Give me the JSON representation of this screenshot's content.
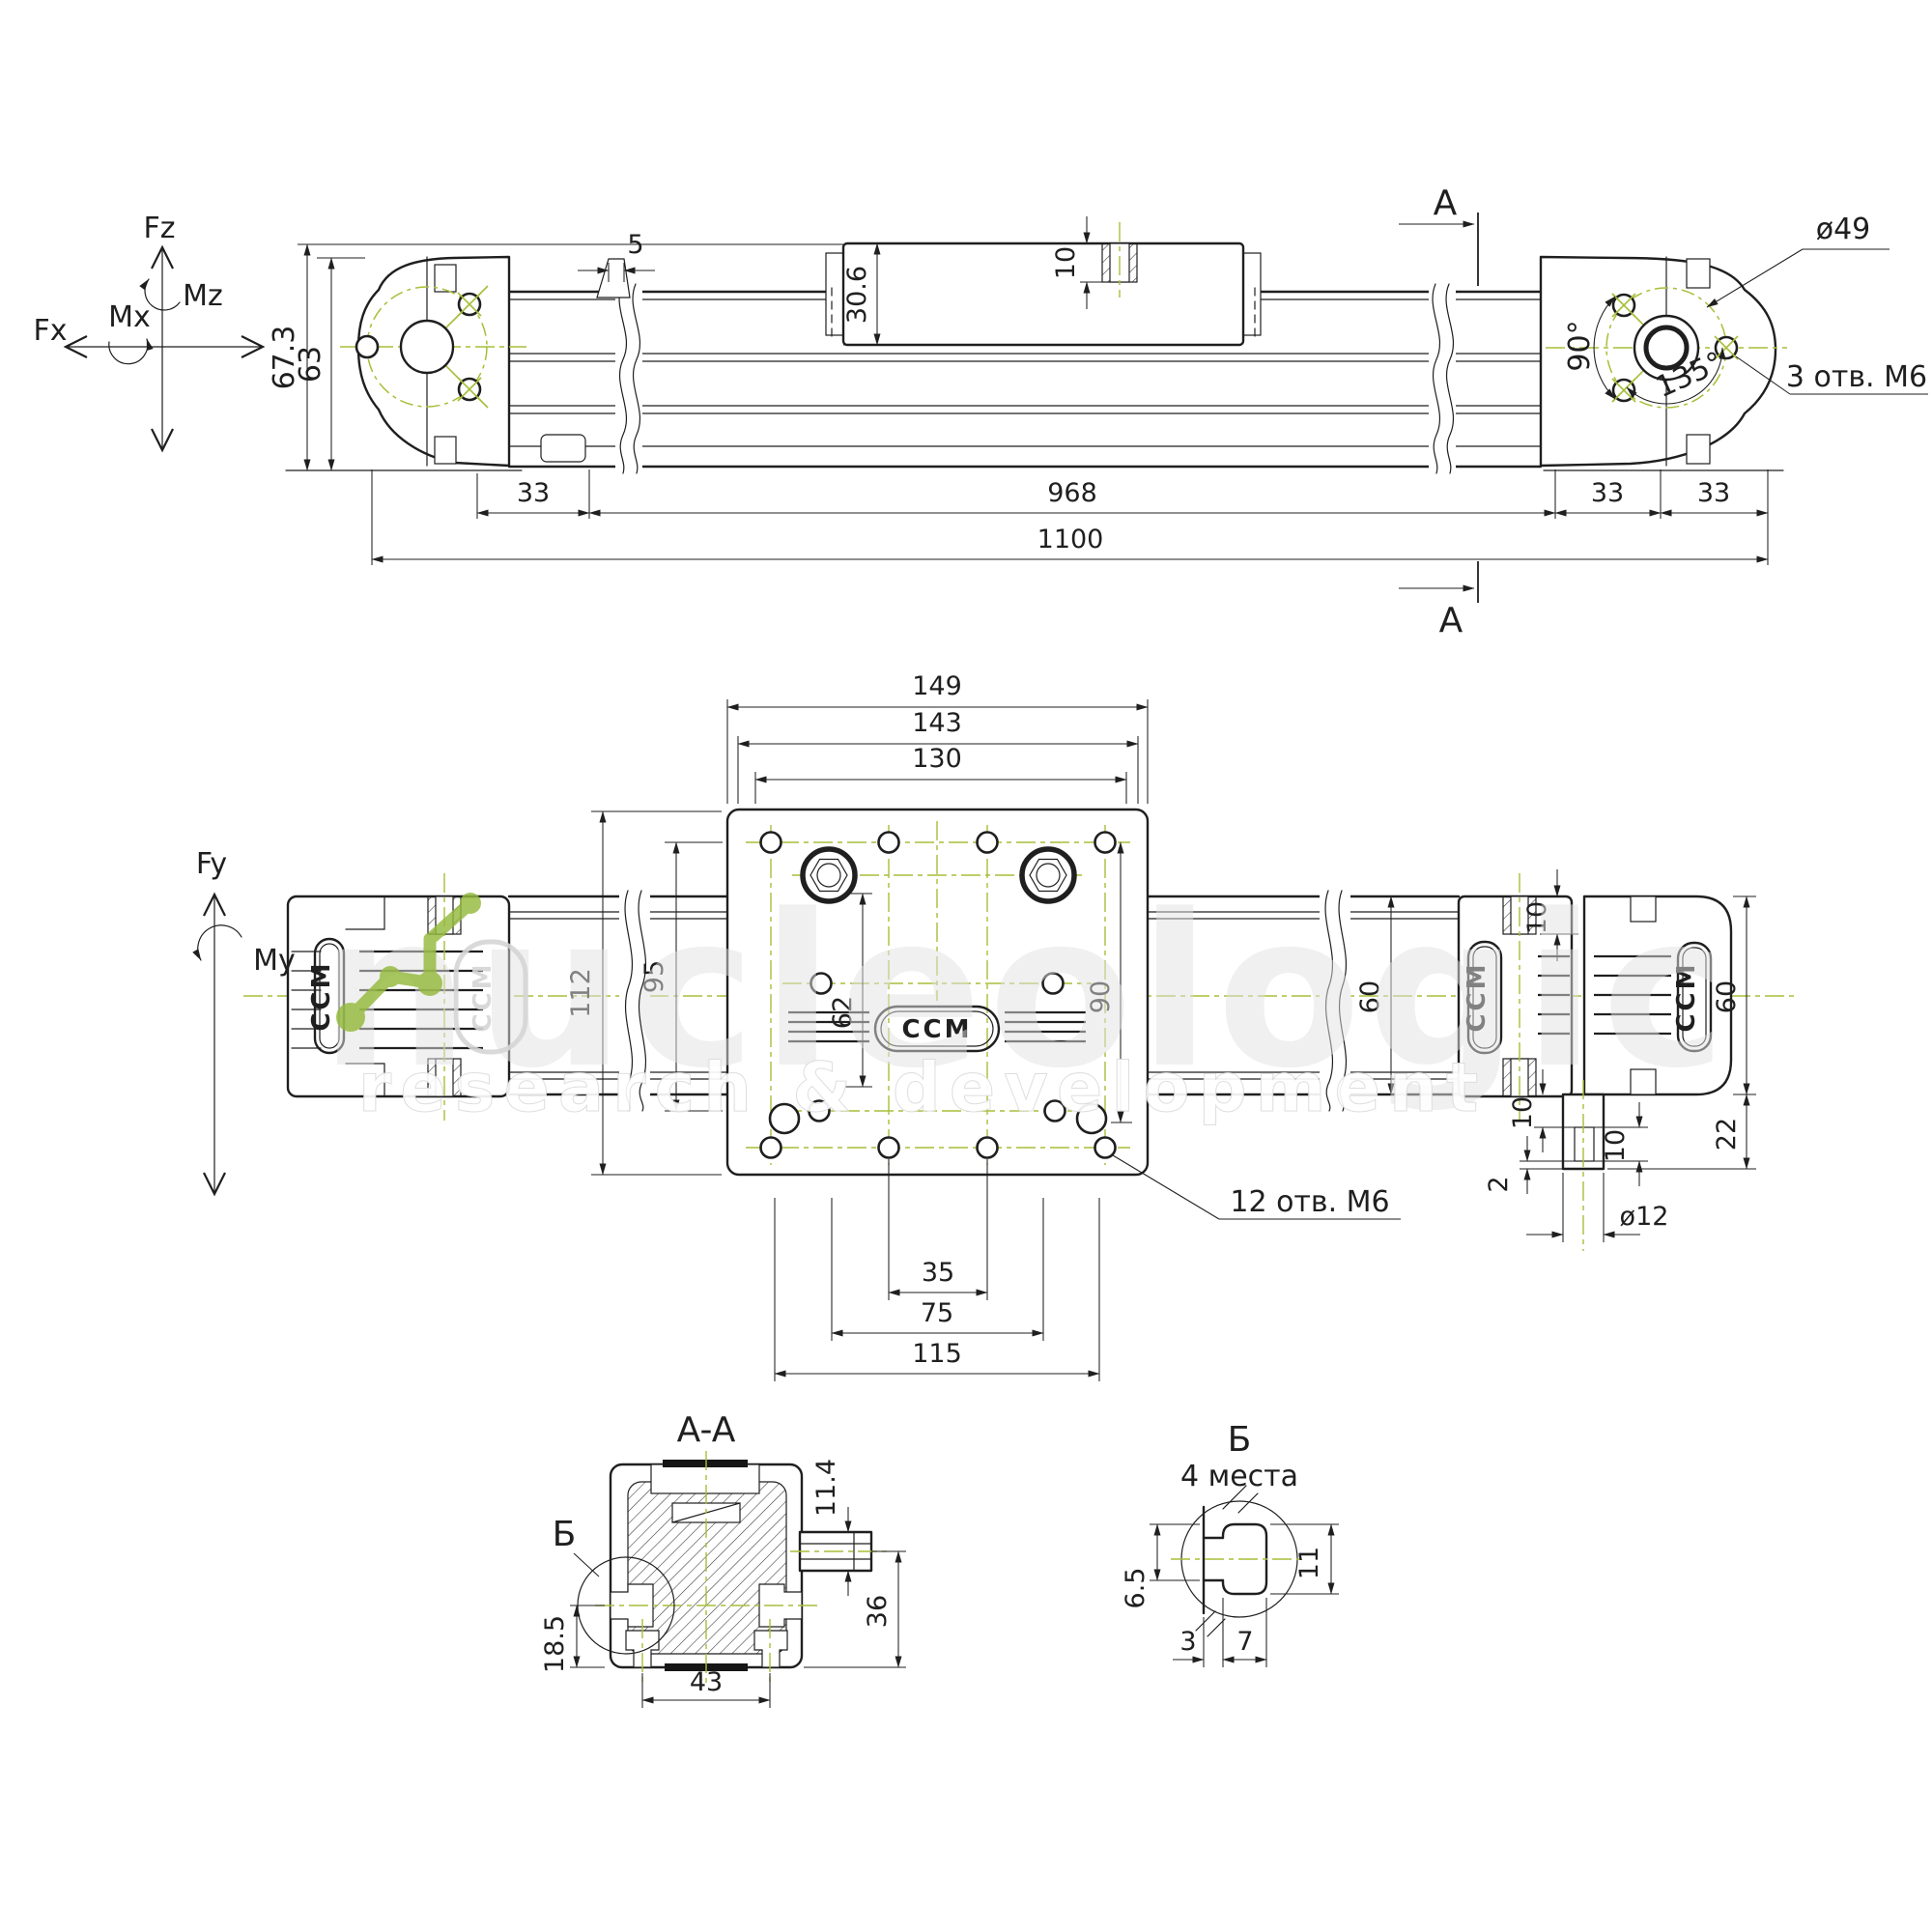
{
  "colors": {
    "line": "#1f1f1f",
    "centerline_green": "#a6bf39",
    "watermark_green": "#94ba3c",
    "watermark_gray": "#e2e2e2"
  },
  "force": {
    "fz": "Fz",
    "mz": "Mz",
    "mx": "Mx",
    "fx": "Fx",
    "fy": "Fy",
    "my": "My"
  },
  "side": {
    "h_overall": "67.3",
    "h_body": "63",
    "cap_offset": "5",
    "carriage_h": "30.6",
    "thread_depth": "10",
    "seg_33l": "33",
    "seg_968": "968",
    "seg_33r1": "33",
    "seg_33r2": "33",
    "total": "1100",
    "bolt_circle": "ø49",
    "ang90": "90°",
    "ang135": "135°",
    "holes": "3 отв. М6",
    "sec_top": "A",
    "sec_bot": "A"
  },
  "plan": {
    "w149": "149",
    "w143": "143",
    "w130": "130",
    "h112": "112",
    "h95": "95",
    "h62": "62",
    "h90": "90",
    "depth10": "10",
    "rail60": "60",
    "cap60": "60",
    "h22": "22",
    "off10": "10",
    "tab10": "10",
    "tip2": "2",
    "rod": "ø12",
    "w35": "35",
    "w75": "75",
    "w115": "115",
    "holes": "12 отв. М6",
    "logo": "CCM"
  },
  "aa": {
    "title": "A-A",
    "d114": "11.4",
    "d36": "36",
    "d43": "43",
    "d185": "18.5",
    "ref": "Б"
  },
  "b": {
    "title": "Б",
    "sub": "4 места",
    "d11": "11",
    "d65": "6.5",
    "d3": "3",
    "d7": "7"
  },
  "watermark": {
    "brand": "nucleologic",
    "subtitle": "research & development"
  }
}
